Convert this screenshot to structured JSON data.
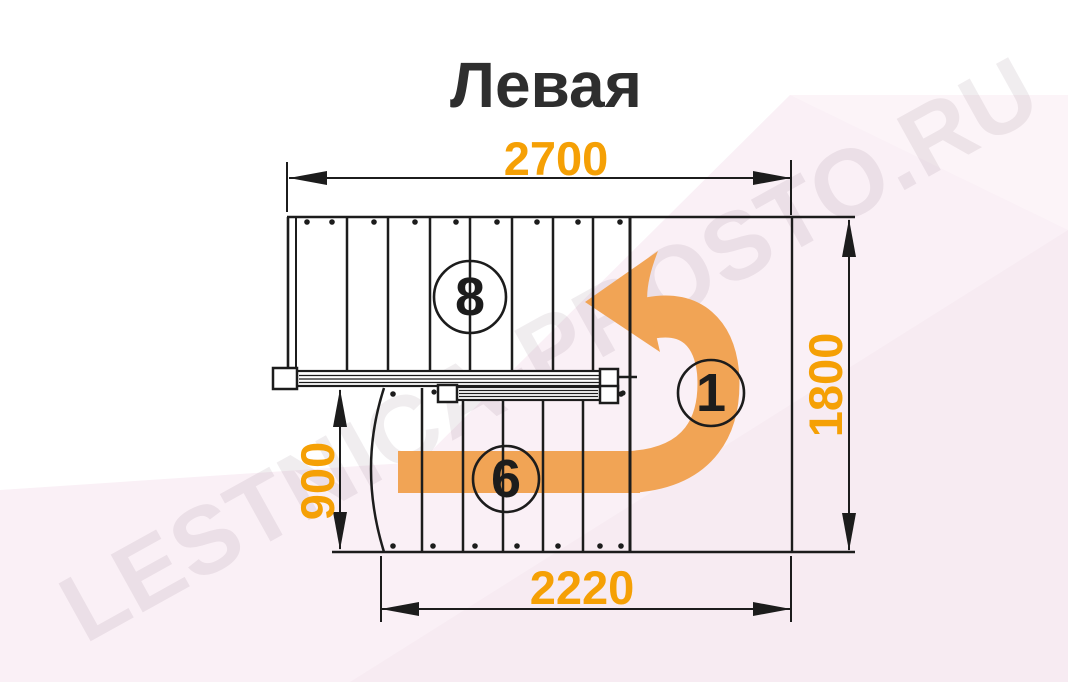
{
  "title": "Левая",
  "watermark": "LESTNICA-PROSTO.RU",
  "dimensions": {
    "top_width": "2700",
    "right_height": "1800",
    "left_height": "900",
    "bottom_width": "2220"
  },
  "step_labels": {
    "upper_flight": "8",
    "turn": "1",
    "lower_flight": "6"
  },
  "colors": {
    "dimension_text": "#F5A005",
    "arrow_orange": "#F1A455",
    "line_black": "#1C1C1C",
    "background_tint": "#FAF0F6"
  }
}
